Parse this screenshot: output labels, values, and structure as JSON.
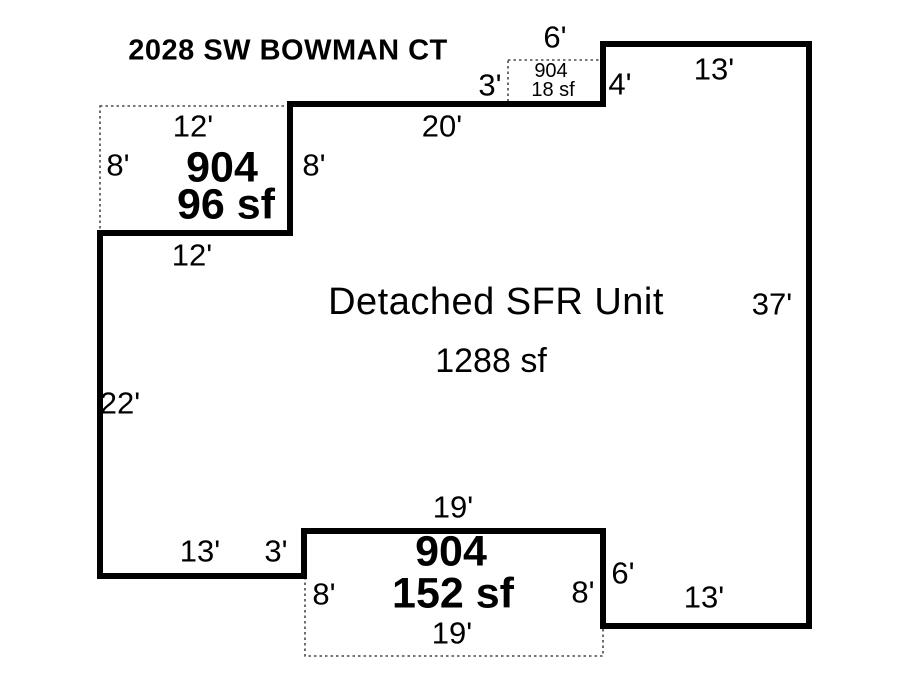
{
  "title": "2028 SW BOWMAN CT",
  "unit": {
    "name": "Detached SFR Unit",
    "area": "1288 sf"
  },
  "walls": {
    "top": "20'",
    "top_right": "13'",
    "right": "37'",
    "left": "22'",
    "bottom_left": "13'",
    "bottom_left_step": "3'",
    "bottom_right_step": "6'",
    "bottom_right": "13'",
    "upper_step_right": "4'",
    "upper_porch_right": "8'",
    "upper_porch_bottom": "12'"
  },
  "porches": {
    "upper_left": {
      "id": "904",
      "area": "96 sf",
      "top_dim": "12'",
      "left_dim": "8'"
    },
    "top": {
      "id": "904",
      "area": "18 sf",
      "top_dim": "6'",
      "left_dim": "3'"
    },
    "bottom": {
      "id": "904",
      "area": "152 sf",
      "top_dim": "19'",
      "left_dim": "8'",
      "right_dim": "8'",
      "bottom_dim": "19'"
    }
  },
  "colors": {
    "line": "#000000",
    "dotted_line": "#4a4a4a",
    "background": "#ffffff"
  }
}
